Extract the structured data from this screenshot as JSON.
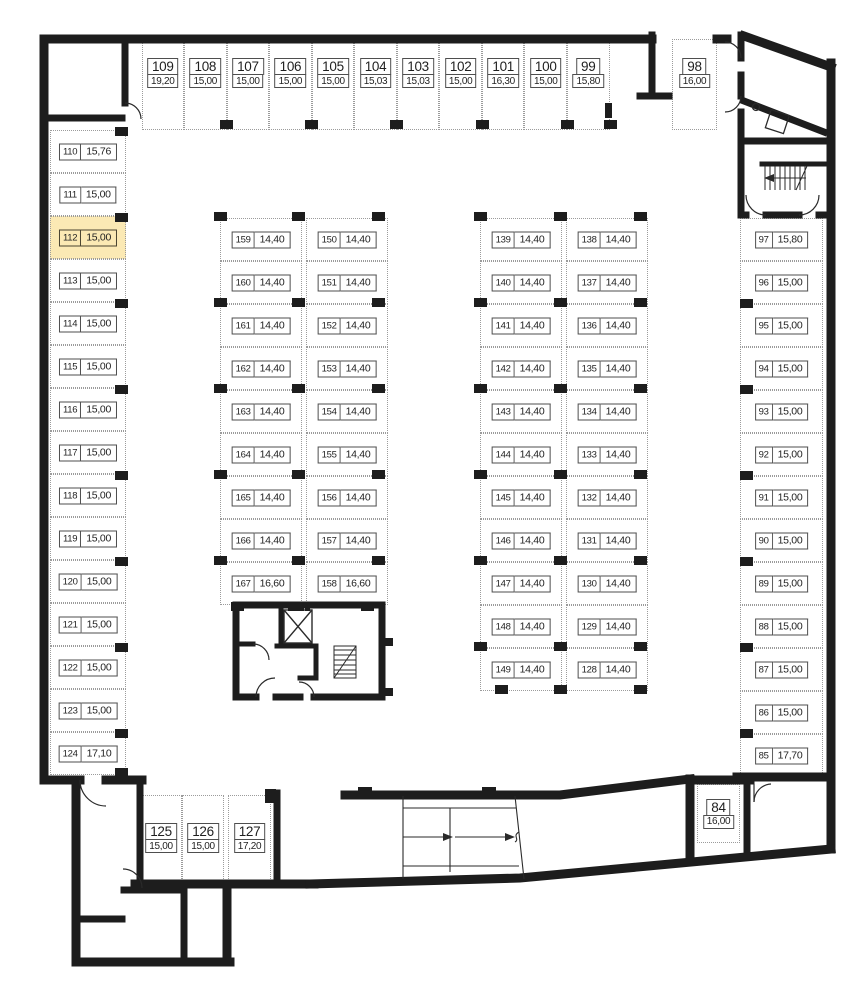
{
  "plan": {
    "type": "parking-floor-plan",
    "highlighted_spot": "112",
    "colors": {
      "wall": "#1d1d1d",
      "highlight_fill": "#fbe9b4",
      "dotted_line": "#9b9b9b",
      "label_border": "#4e4e4e",
      "text": "#1f1f1f"
    }
  },
  "spot_groups": [
    {
      "name": "top-row",
      "label_style": "stacked",
      "spots": [
        {
          "num": "109",
          "area": "19,20"
        },
        {
          "num": "108",
          "area": "15,00"
        },
        {
          "num": "107",
          "area": "15,00"
        },
        {
          "num": "106",
          "area": "15,00"
        },
        {
          "num": "105",
          "area": "15,00"
        },
        {
          "num": "104",
          "area": "15,03"
        },
        {
          "num": "103",
          "area": "15,03"
        },
        {
          "num": "102",
          "area": "15,00"
        },
        {
          "num": "101",
          "area": "16,30"
        },
        {
          "num": "100",
          "area": "15,00"
        },
        {
          "num": "99",
          "area": "15,80"
        }
      ]
    },
    {
      "name": "spot-98",
      "label_style": "stacked",
      "spots": [
        {
          "num": "98",
          "area": "16,00"
        }
      ]
    },
    {
      "name": "left-column",
      "label_style": "inline",
      "spots": [
        {
          "num": "110",
          "area": "15,76"
        },
        {
          "num": "111",
          "area": "15,00"
        },
        {
          "num": "112",
          "area": "15,00"
        },
        {
          "num": "113",
          "area": "15,00"
        },
        {
          "num": "114",
          "area": "15,00"
        },
        {
          "num": "115",
          "area": "15,00"
        },
        {
          "num": "116",
          "area": "15,00"
        },
        {
          "num": "117",
          "area": "15,00"
        },
        {
          "num": "118",
          "area": "15,00"
        },
        {
          "num": "119",
          "area": "15,00"
        },
        {
          "num": "120",
          "area": "15,00"
        },
        {
          "num": "121",
          "area": "15,00"
        },
        {
          "num": "122",
          "area": "15,00"
        },
        {
          "num": "123",
          "area": "15,00"
        },
        {
          "num": "124",
          "area": "17,10"
        }
      ]
    },
    {
      "name": "inner-west-a",
      "label_style": "inline",
      "spots": [
        {
          "num": "159",
          "area": "14,40"
        },
        {
          "num": "160",
          "area": "14,40"
        },
        {
          "num": "161",
          "area": "14,40"
        },
        {
          "num": "162",
          "area": "14,40"
        },
        {
          "num": "163",
          "area": "14,40"
        },
        {
          "num": "164",
          "area": "14,40"
        },
        {
          "num": "165",
          "area": "14,40"
        },
        {
          "num": "166",
          "area": "14,40"
        },
        {
          "num": "167",
          "area": "16,60"
        }
      ]
    },
    {
      "name": "inner-west-b",
      "label_style": "inline",
      "spots": [
        {
          "num": "150",
          "area": "14,40"
        },
        {
          "num": "151",
          "area": "14,40"
        },
        {
          "num": "152",
          "area": "14,40"
        },
        {
          "num": "153",
          "area": "14,40"
        },
        {
          "num": "154",
          "area": "14,40"
        },
        {
          "num": "155",
          "area": "14,40"
        },
        {
          "num": "156",
          "area": "14,40"
        },
        {
          "num": "157",
          "area": "14,40"
        },
        {
          "num": "158",
          "area": "16,60"
        }
      ]
    },
    {
      "name": "inner-east-a",
      "label_style": "inline",
      "spots": [
        {
          "num": "139",
          "area": "14,40"
        },
        {
          "num": "140",
          "area": "14,40"
        },
        {
          "num": "141",
          "area": "14,40"
        },
        {
          "num": "142",
          "area": "14,40"
        },
        {
          "num": "143",
          "area": "14,40"
        },
        {
          "num": "144",
          "area": "14,40"
        },
        {
          "num": "145",
          "area": "14,40"
        },
        {
          "num": "146",
          "area": "14,40"
        },
        {
          "num": "147",
          "area": "14,40"
        },
        {
          "num": "148",
          "area": "14,40"
        },
        {
          "num": "149",
          "area": "14,40"
        }
      ]
    },
    {
      "name": "inner-east-b",
      "label_style": "inline",
      "spots": [
        {
          "num": "138",
          "area": "14,40"
        },
        {
          "num": "137",
          "area": "14,40"
        },
        {
          "num": "136",
          "area": "14,40"
        },
        {
          "num": "135",
          "area": "14,40"
        },
        {
          "num": "134",
          "area": "14,40"
        },
        {
          "num": "133",
          "area": "14,40"
        },
        {
          "num": "132",
          "area": "14,40"
        },
        {
          "num": "131",
          "area": "14,40"
        },
        {
          "num": "130",
          "area": "14,40"
        },
        {
          "num": "129",
          "area": "14,40"
        },
        {
          "num": "128",
          "area": "14,40"
        }
      ]
    },
    {
      "name": "right-column",
      "label_style": "inline",
      "spots": [
        {
          "num": "97",
          "area": "15,80"
        },
        {
          "num": "96",
          "area": "15,00"
        },
        {
          "num": "95",
          "area": "15,00"
        },
        {
          "num": "94",
          "area": "15,00"
        },
        {
          "num": "93",
          "area": "15,00"
        },
        {
          "num": "92",
          "area": "15,00"
        },
        {
          "num": "91",
          "area": "15,00"
        },
        {
          "num": "90",
          "area": "15,00"
        },
        {
          "num": "89",
          "area": "15,00"
        },
        {
          "num": "88",
          "area": "15,00"
        },
        {
          "num": "87",
          "area": "15,00"
        },
        {
          "num": "86",
          "area": "15,00"
        },
        {
          "num": "85",
          "area": "17,70"
        }
      ]
    },
    {
      "name": "bottom-row",
      "label_style": "stacked",
      "spots": [
        {
          "num": "125",
          "area": "15,00"
        },
        {
          "num": "126",
          "area": "15,00"
        },
        {
          "num": "127",
          "area": "17,20"
        }
      ]
    },
    {
      "name": "spot-84",
      "label_style": "stacked",
      "spots": [
        {
          "num": "84",
          "area": "16,00"
        }
      ]
    }
  ]
}
